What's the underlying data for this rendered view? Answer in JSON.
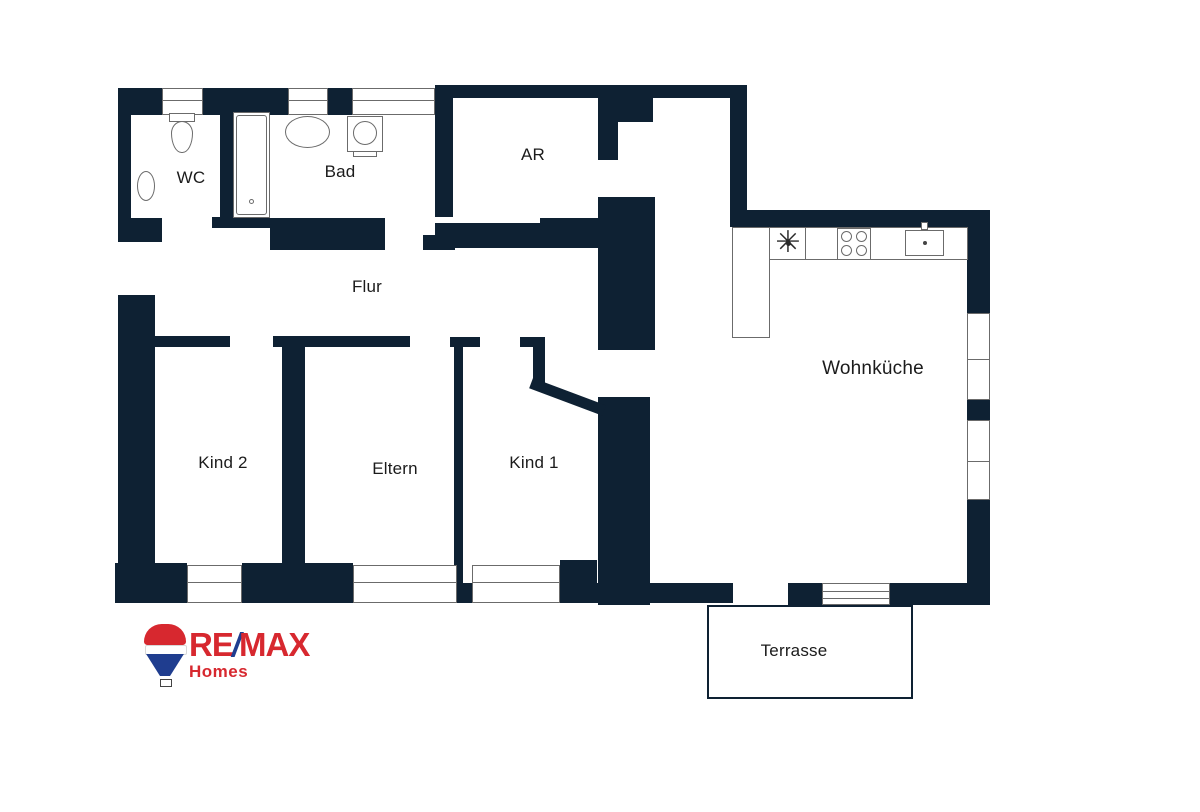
{
  "plan": {
    "wall_color": "#0e2133",
    "line_color": "#6b6b6b",
    "label_color": "#1b1b1b",
    "canvas": {
      "width": 1200,
      "height": 812
    },
    "rooms": [
      {
        "id": "wc",
        "label": "WC",
        "cx": 191,
        "cy": 178,
        "size": 17
      },
      {
        "id": "bad",
        "label": "Bad",
        "cx": 340,
        "cy": 172,
        "size": 17
      },
      {
        "id": "ar",
        "label": "AR",
        "cx": 533,
        "cy": 155,
        "size": 17
      },
      {
        "id": "flur",
        "label": "Flur",
        "cx": 367,
        "cy": 287,
        "size": 17
      },
      {
        "id": "kind2",
        "label": "Kind 2",
        "cx": 223,
        "cy": 463,
        "size": 17
      },
      {
        "id": "eltern",
        "label": "Eltern",
        "cx": 395,
        "cy": 469,
        "size": 17
      },
      {
        "id": "kind1",
        "label": "Kind 1",
        "cx": 534,
        "cy": 463,
        "size": 17
      },
      {
        "id": "wohnkueche",
        "label": "Wohnküche",
        "cx": 873,
        "cy": 369,
        "size": 19
      },
      {
        "id": "terrasse",
        "label": "Terrasse",
        "cx": 794,
        "cy": 651,
        "size": 17
      }
    ],
    "walls": [
      [
        118,
        88,
        13,
        132
      ],
      [
        118,
        88,
        44,
        27
      ],
      [
        203,
        88,
        85,
        27
      ],
      [
        328,
        88,
        24,
        27
      ],
      [
        118,
        218,
        44,
        24
      ],
      [
        220,
        108,
        13,
        110
      ],
      [
        212,
        217,
        58,
        11
      ],
      [
        270,
        218,
        115,
        32
      ],
      [
        435,
        85,
        183,
        13
      ],
      [
        435,
        85,
        18,
        132
      ],
      [
        598,
        85,
        20,
        75
      ],
      [
        618,
        95,
        35,
        27
      ],
      [
        618,
        85,
        129,
        13
      ],
      [
        423,
        235,
        32,
        15
      ],
      [
        435,
        223,
        163,
        25
      ],
      [
        540,
        218,
        58,
        30
      ],
      [
        730,
        98,
        17,
        117
      ],
      [
        730,
        210,
        255,
        17
      ],
      [
        967,
        210,
        23,
        103
      ],
      [
        967,
        400,
        23,
        20
      ],
      [
        967,
        500,
        23,
        105
      ],
      [
        890,
        583,
        100,
        22
      ],
      [
        788,
        583,
        34,
        22
      ],
      [
        560,
        583,
        173,
        20
      ],
      [
        560,
        560,
        37,
        43
      ],
      [
        118,
        295,
        37,
        308
      ],
      [
        115,
        563,
        72,
        40
      ],
      [
        242,
        563,
        111,
        40
      ],
      [
        448,
        583,
        24,
        20
      ],
      [
        153,
        336,
        77,
        11
      ],
      [
        273,
        336,
        137,
        11
      ],
      [
        450,
        337,
        30,
        10
      ],
      [
        520,
        337,
        25,
        10
      ],
      [
        282,
        347,
        23,
        216
      ],
      [
        454,
        347,
        9,
        236
      ],
      [
        533,
        347,
        12,
        36
      ],
      [
        598,
        197,
        57,
        153
      ],
      [
        598,
        397,
        52,
        208
      ]
    ],
    "diagonal": {
      "x": 533,
      "y": 378,
      "w": 78,
      "h": 11,
      "angle": 20.5
    },
    "windows_h": [
      {
        "x": 162,
        "y": 88,
        "w": 41,
        "h": 27
      },
      {
        "x": 288,
        "y": 88,
        "w": 40,
        "h": 27
      },
      {
        "x": 352,
        "y": 88,
        "w": 83,
        "h": 27
      },
      {
        "x": 187,
        "y": 565,
        "w": 55,
        "h": 38
      },
      {
        "x": 353,
        "y": 565,
        "w": 104,
        "h": 38
      },
      {
        "x": 472,
        "y": 565,
        "w": 88,
        "h": 38
      }
    ],
    "windows_v": [
      {
        "x": 967,
        "y": 313,
        "w": 23,
        "h": 87,
        "split": 45
      },
      {
        "x": 967,
        "y": 420,
        "w": 23,
        "h": 80,
        "split": 40
      }
    ],
    "terrace_door": {
      "x": 822,
      "y": 583,
      "w": 68,
      "h": 22
    },
    "terrace": {
      "x": 707,
      "y": 605,
      "w": 206,
      "h": 94
    },
    "counters": [
      {
        "x": 732,
        "y": 227,
        "w": 236,
        "h": 33
      },
      {
        "x": 732,
        "y": 227,
        "w": 38,
        "h": 111
      }
    ],
    "counter_divider": {
      "x": 805,
      "y": 227,
      "w": 1,
      "h": 33
    },
    "fixtures": [
      {
        "type": "toilet",
        "x": 169,
        "y": 113,
        "w": 26,
        "h": 42
      },
      {
        "type": "wc-sink",
        "x": 137,
        "y": 171,
        "w": 18,
        "h": 30
      },
      {
        "type": "bathtub",
        "x": 233,
        "y": 112,
        "w": 37,
        "h": 106
      },
      {
        "type": "bad-sink",
        "x": 285,
        "y": 116,
        "w": 45,
        "h": 32
      },
      {
        "type": "washer",
        "x": 347,
        "y": 116,
        "w": 36,
        "h": 42
      },
      {
        "type": "star",
        "x": 771,
        "y": 226,
        "w": 34,
        "h": 34
      },
      {
        "type": "stove",
        "x": 837,
        "y": 228,
        "w": 34,
        "h": 32
      },
      {
        "type": "kitchen-sink",
        "x": 905,
        "y": 230,
        "w": 39,
        "h": 26
      }
    ]
  },
  "logo": {
    "re": "RE",
    "slash": "/",
    "max": "MAX",
    "homes": "Homes",
    "balloon_text": "RE/MAX",
    "red": "#d7282f",
    "blue": "#1f3d8f"
  }
}
